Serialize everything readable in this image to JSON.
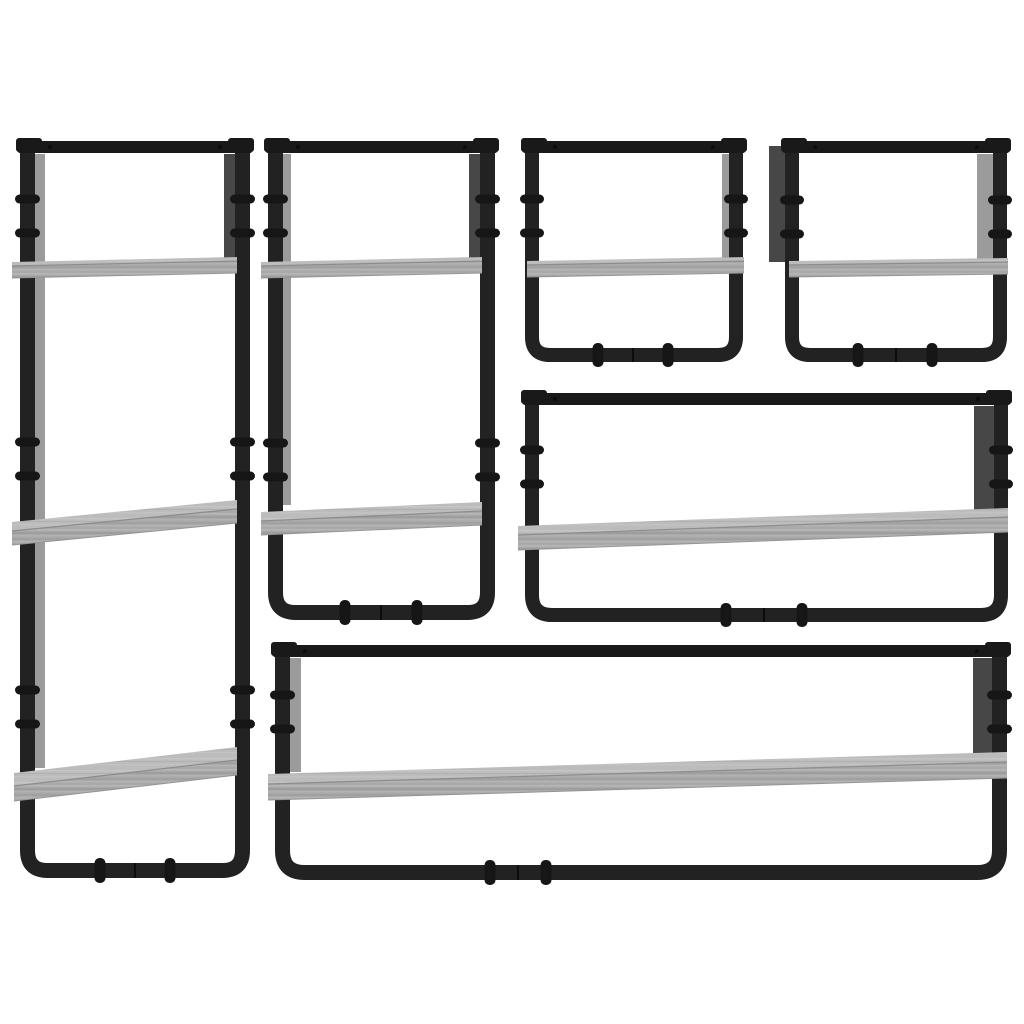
{
  "product": {
    "name": "wall-shelf-set",
    "description": "6 piece wall shelf set with bars, black steel frames and grey sonoma engineered wood boards, product photo on white background",
    "piece_count": 6
  },
  "canvas": {
    "width": 1024,
    "height": 1024,
    "background": "#ffffff"
  },
  "colors": {
    "frame": "#222222",
    "frame_top": "#191919",
    "frame_dark": "#0d0d0d",
    "panel_dark": "#474747",
    "panel_light": "#9b9b9b",
    "bolt": "#161616",
    "rivet": "#0d0d0d",
    "seam": "#0c0c0c",
    "wood_top": "#bcbcbc",
    "wood_front": "#a9a9a9",
    "shelf_edge_line": "#8c8c8c",
    "shelf_bottom_line": "#949494",
    "wood_top_streaks": [
      {
        "y": 2,
        "h": 1.5,
        "c": "#c7c7c7"
      },
      {
        "y": 5,
        "h": 1.0,
        "c": "#b1b1b1"
      },
      {
        "y": 8,
        "h": 1.5,
        "c": "#c3c3c3"
      }
    ],
    "wood_front_streaks": [
      {
        "y": 1,
        "h": 1.5,
        "c": "#b7b7b7"
      },
      {
        "y": 4,
        "h": 2.0,
        "c": "#9d9d9d"
      },
      {
        "y": 7,
        "h": 1.5,
        "c": "#b2b2b2"
      },
      {
        "y": 10,
        "h": 2.0,
        "c": "#a0a0a0"
      },
      {
        "y": 13,
        "h": 1.5,
        "c": "#b5b5b5"
      }
    ]
  },
  "units": [
    {
      "name": "unit-1-tall-3-tier-shelf",
      "frame": {
        "x1": 20,
        "x2": 250,
        "top": 141,
        "bottom": 878,
        "rail_w": 15,
        "top_rail_h": 12,
        "corner_r": 20
      },
      "panels": [
        {
          "x": 34,
          "w": 11,
          "y1": 154,
          "y2": 768,
          "tone": "light"
        },
        {
          "x": 224,
          "w": 11,
          "y1": 154,
          "y2": 259,
          "tone": "dark"
        }
      ],
      "shelves": [
        {
          "x1": 12,
          "x2": 237,
          "yr": 257,
          "drop": 5,
          "td": 4,
          "fh": 12
        },
        {
          "x1": 12,
          "x2": 237,
          "yr": 500,
          "drop": 22,
          "td": 9,
          "fh": 14
        },
        {
          "x1": 14,
          "x2": 237,
          "yr": 747,
          "drop": 26,
          "td": 13,
          "fh": 15
        }
      ],
      "bolts": [
        199,
        233,
        442,
        476,
        690,
        724
      ],
      "clips": [
        100,
        170
      ],
      "seam": 135
    },
    {
      "name": "unit-2-two-tier-shelf",
      "frame": {
        "x1": 268,
        "x2": 495,
        "top": 141,
        "bottom": 620,
        "rail_w": 15,
        "top_rail_h": 12,
        "corner_r": 20
      },
      "panels": [
        {
          "x": 282,
          "w": 9,
          "y1": 154,
          "y2": 505,
          "tone": "light"
        },
        {
          "x": 469,
          "w": 11,
          "y1": 154,
          "y2": 259,
          "tone": "dark"
        }
      ],
      "shelves": [
        {
          "x1": 261,
          "x2": 482,
          "yr": 257,
          "drop": 5,
          "td": 4,
          "fh": 12
        },
        {
          "x1": 261,
          "x2": 482,
          "yr": 502,
          "drop": 10,
          "td": 9,
          "fh": 14
        }
      ],
      "bolts": [
        199,
        233,
        443,
        477
      ],
      "clips": [
        345,
        417
      ],
      "seam": 381
    },
    {
      "name": "unit-3-small-shelf-left",
      "frame": {
        "x1": 525,
        "x2": 743,
        "top": 141,
        "bottom": 362,
        "rail_w": 14,
        "top_rail_h": 12,
        "corner_r": 18
      },
      "panels": [
        {
          "x": 722,
          "w": 7,
          "y1": 154,
          "y2": 258,
          "tone": "light"
        }
      ],
      "shelves": [
        {
          "x1": 527,
          "x2": 744,
          "yr": 257,
          "drop": 4,
          "td": 4,
          "fh": 12
        }
      ],
      "bolts": [
        199,
        233
      ],
      "clips": [
        598,
        668
      ],
      "seam": 633
    },
    {
      "name": "unit-4-small-shelf-right",
      "frame": {
        "x1": 785,
        "x2": 1007,
        "top": 141,
        "bottom": 362,
        "rail_w": 14,
        "top_rail_h": 12,
        "corner_r": 18
      },
      "panels": [
        {
          "x": 769,
          "w": 17,
          "y1": 146,
          "y2": 262,
          "tone": "dark"
        },
        {
          "x": 977,
          "w": 16,
          "y1": 154,
          "y2": 259,
          "tone": "light"
        }
      ],
      "shelves": [
        {
          "x1": 789,
          "x2": 1008,
          "yr": 258,
          "drop": 3,
          "td": 4,
          "fh": 12
        }
      ],
      "bolts": [
        200,
        234
      ],
      "clips": [
        858,
        932
      ],
      "seam": 896
    },
    {
      "name": "unit-5-wide-shelf",
      "frame": {
        "x1": 525,
        "x2": 1008,
        "top": 393,
        "bottom": 622,
        "rail_w": 14,
        "top_rail_h": 12,
        "corner_r": 20
      },
      "panels": [
        {
          "x": 974,
          "w": 21,
          "y1": 406,
          "y2": 519,
          "tone": "dark"
        }
      ],
      "shelves": [
        {
          "x1": 518,
          "x2": 1008,
          "yr": 508,
          "drop": 18,
          "td": 9,
          "fh": 15
        }
      ],
      "bolts": [
        450,
        484
      ],
      "clips": [
        726,
        802
      ],
      "seam": 764
    },
    {
      "name": "unit-6-extra-wide-shelf",
      "frame": {
        "x1": 275,
        "x2": 1007,
        "top": 645,
        "bottom": 880,
        "rail_w": 15,
        "top_rail_h": 12,
        "corner_r": 22
      },
      "panels": [
        {
          "x": 289,
          "w": 12,
          "y1": 658,
          "y2": 772,
          "tone": "light"
        },
        {
          "x": 973,
          "w": 21,
          "y1": 658,
          "y2": 756,
          "tone": "dark"
        }
      ],
      "shelves": [
        {
          "x1": 268,
          "x2": 1007,
          "yr": 752,
          "drop": 22,
          "td": 10,
          "fh": 16
        }
      ],
      "bolts": [
        695,
        729
      ],
      "clips": [
        490,
        546
      ],
      "seam": 518
    }
  ]
}
